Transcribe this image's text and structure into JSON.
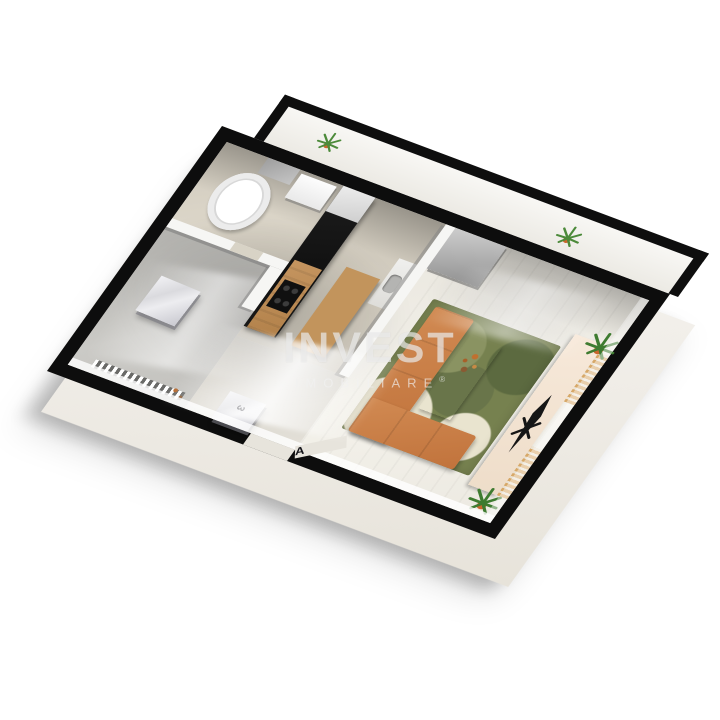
{
  "image_type": "3d-floor-plan-render",
  "watermark": {
    "brand": "INVEST",
    "tagline": "IMOBILIARE",
    "registered": "®"
  },
  "annotations": {
    "entrance_mark": "A",
    "cabinet_mark": "3"
  },
  "palette": {
    "background": "#ffffff",
    "outer_wall": "#0d0d0d",
    "slab": "#f4f2ed",
    "sofa": "#c67c45",
    "rug": "#76814f",
    "wood": "#bd8a52",
    "kitchen_cabinets": "#151515",
    "tv_stand": "#f3e3d1",
    "plant_leaf": "#3e7b30",
    "plant_pot": "#c9662c",
    "radiator": "#d7a868",
    "marble": "#e9e9ee",
    "bathtub": "#ffffff"
  },
  "rooms": [
    {
      "name": "balcony",
      "items": [
        "plant",
        "plant"
      ]
    },
    {
      "name": "bathroom",
      "items": [
        "bathtub",
        "vanity",
        "mirror",
        "bath-mat"
      ]
    },
    {
      "name": "kitchen",
      "items": [
        "tall-cabinet-run",
        "countertop",
        "cooktop",
        "sink",
        "dining-table"
      ]
    },
    {
      "name": "hallway",
      "items": [
        "marble-wardrobe",
        "marble-wardrobe",
        "entrance-door"
      ]
    },
    {
      "name": "left-room",
      "items": [
        "radiator",
        "decor"
      ]
    },
    {
      "name": "living-room",
      "items": [
        "closet",
        "area-rug",
        "sectional-sofa",
        "coffee-table",
        "tv-stand",
        "tv",
        "plant",
        "plant",
        "radiator",
        "radiator"
      ]
    }
  ]
}
